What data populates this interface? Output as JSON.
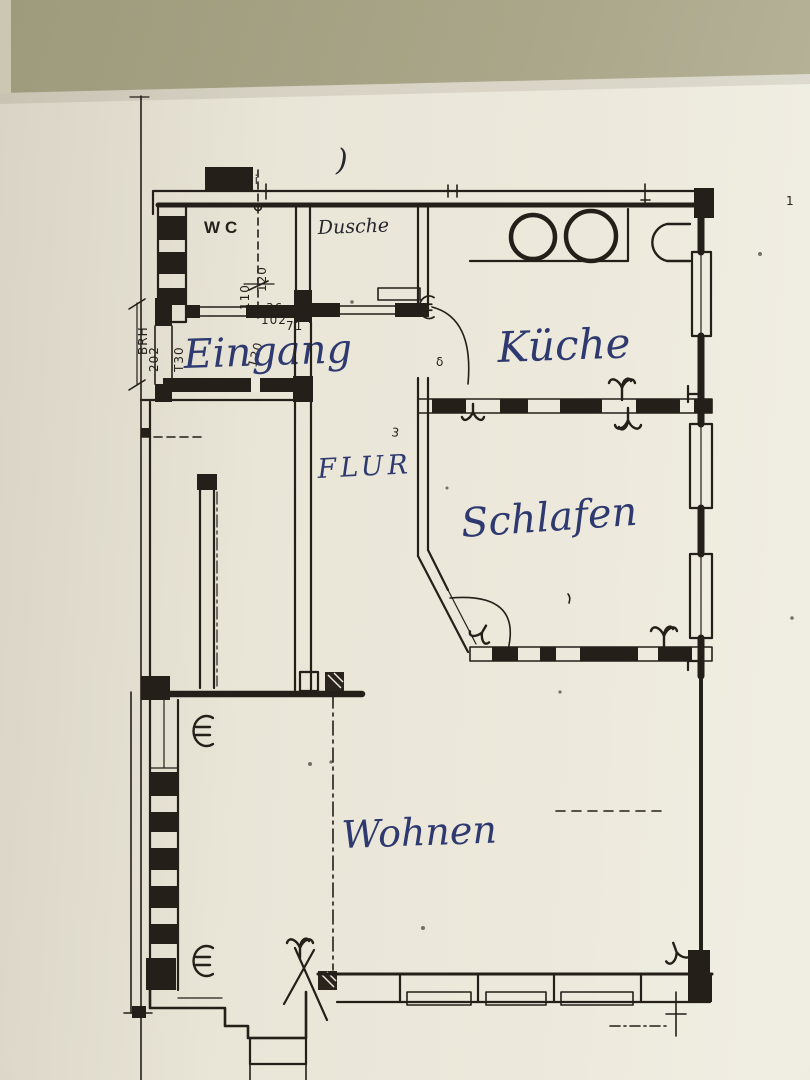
{
  "plan": {
    "rooms": {
      "wc": {
        "label": "WC"
      },
      "dusche": {
        "label": "Dusche"
      },
      "eingang": {
        "label": "Eingang"
      },
      "kueche": {
        "label": "Küche"
      },
      "flur": {
        "label": "FLUR"
      },
      "schlafen": {
        "label": "Schlafen"
      },
      "wohnen": {
        "label": "Wohnen"
      }
    },
    "dimensions": {
      "wc_depth": "120",
      "wc_width": "110",
      "door_a": "36",
      "door_b": "102",
      "door_c": "71",
      "entry_width": "120",
      "parapet_label": "BRH",
      "parapet_height": "202",
      "entry_door_type": "T30",
      "top_note": "2i"
    },
    "marks": {
      "paren_mark": ")",
      "margin_mark": "1",
      "corner_mark": "3",
      "door_small_mark": "δ"
    },
    "colors": {
      "ink": "#241f19",
      "pen_blue": "#2e3a6f",
      "paper": "#ebe7da",
      "background": "#a8a489"
    }
  }
}
